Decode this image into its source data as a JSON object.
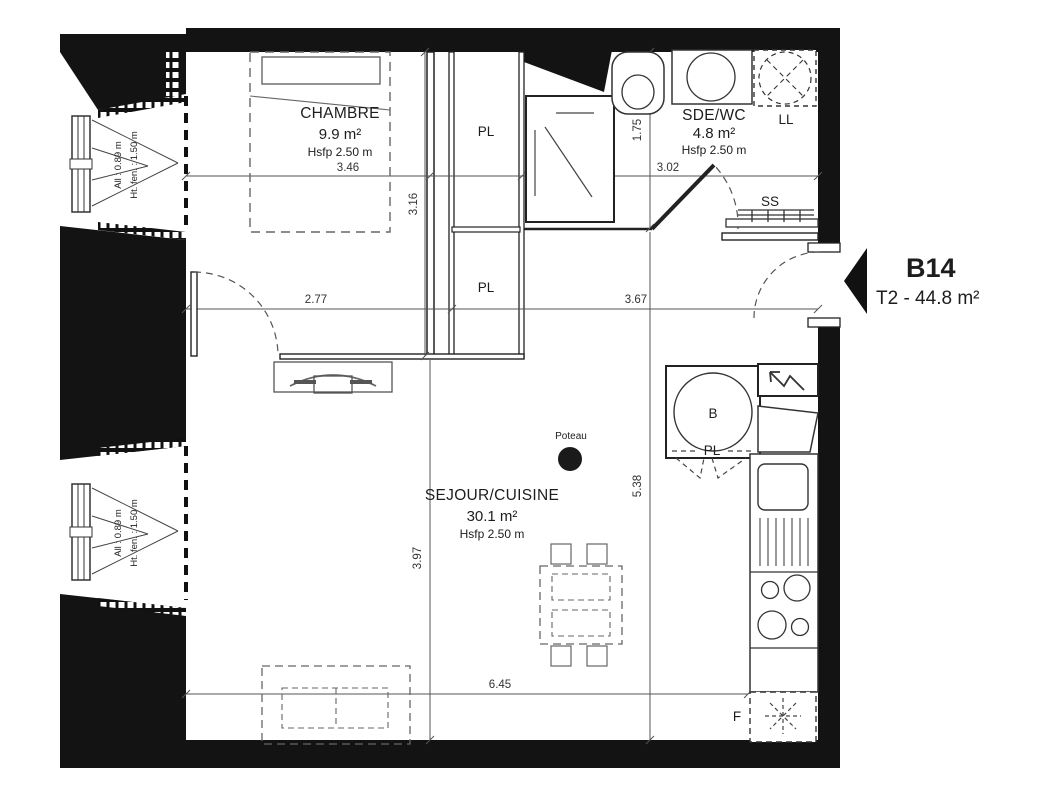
{
  "plan": {
    "unit": {
      "id": "B14",
      "type_area": "T2 - 44.8 m²"
    },
    "rooms": {
      "chambre": {
        "name": "CHAMBRE",
        "area": "9.9 m²",
        "height": "Hsfp 2.50 m"
      },
      "sejour_cuisine": {
        "name": "SEJOUR/CUISINE",
        "area": "30.1 m²",
        "height": "Hsfp 2.50 m"
      },
      "sde_wc": {
        "name": "SDE/WC",
        "area": "4.8 m²",
        "height": "Hsfp 2.50 m"
      }
    },
    "fixtures": {
      "closet_top": "PL",
      "closet_hall": "PL",
      "closet_boiler": "PL",
      "washing_machine": "LL",
      "towel_dryer": "SS",
      "boiler": "B",
      "fridge": "F",
      "column": "Poteau"
    },
    "dimensions": {
      "chambre_width": "3.46",
      "chambre_depth": "3.16",
      "sde_width": "3.02",
      "sde_depth": "1.75",
      "hall_left": "2.77",
      "hall_right": "3.67",
      "sejour_depth_left": "3.97",
      "sejour_depth_right": "5.38",
      "sejour_width": "6.45"
    },
    "window_note": {
      "allege": "All : 0.89 m",
      "fen_height": "Ht. fen. : 1.50 m"
    }
  }
}
